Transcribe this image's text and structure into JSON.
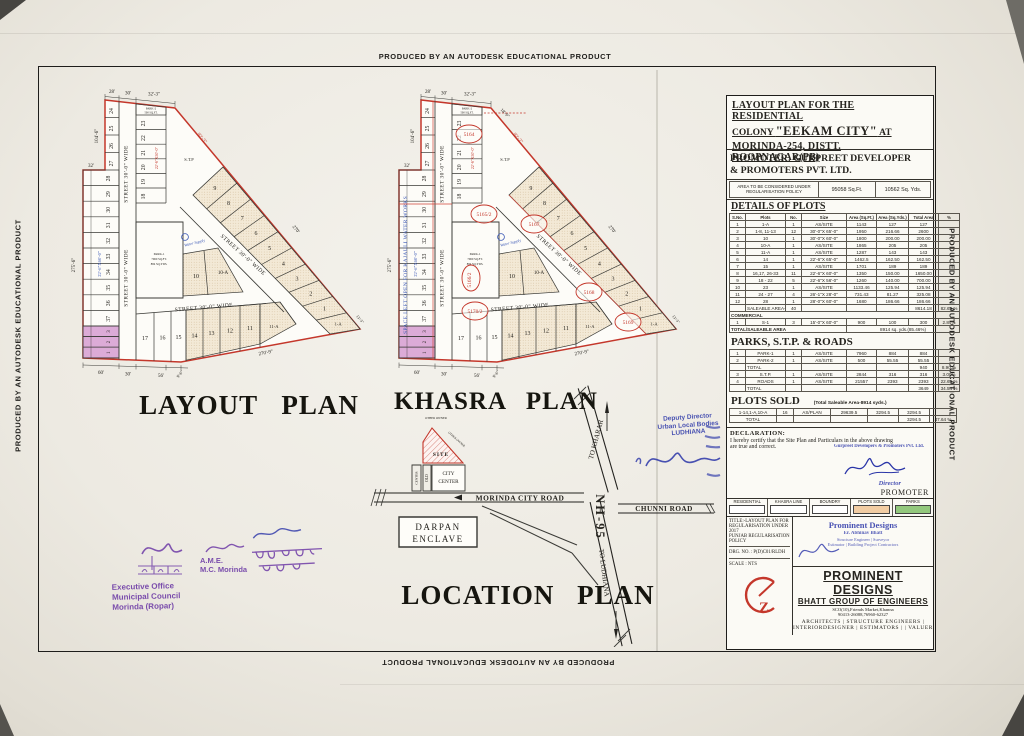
{
  "edge_text": "PRODUCED BY AN AUTODESK EDUCATIONAL PRODUCT",
  "titles": {
    "layout": "LAYOUT PLAN",
    "khasra": "KHASRA PLAN",
    "location": "LOCATION PLAN"
  },
  "colors": {
    "boundary_red": "#c4372b",
    "pink": "#dcabd7",
    "beige": "#f3e9d6",
    "stamp_purple": "#6d3ba6",
    "stamp_blue": "#2a35a8",
    "parks_green": "#93c87d",
    "sold_peach": "#f2cda3"
  },
  "plan": {
    "street_label": "STREET 30'-0\" WIDE",
    "left_plots": [
      "28",
      "29",
      "30",
      "31",
      "32",
      "33",
      "34",
      "35",
      "36",
      "37"
    ],
    "bottom_left_plots": [
      "3",
      "2",
      "1"
    ],
    "top_plots": [
      "24",
      "25",
      "26",
      "27"
    ],
    "mid_plots": [
      "23",
      "22",
      "21",
      "20",
      "19",
      "18"
    ],
    "diag_plots": [
      "9",
      "8",
      "7",
      "6",
      "5",
      "4",
      "3",
      "2",
      "1"
    ],
    "corner_plot": "1-A",
    "bottom_plots": [
      "17",
      "16",
      "15",
      "14",
      "13",
      "12",
      "11"
    ],
    "plot_11a": "11-A",
    "plot_10": "10",
    "plot_10a": "10-A",
    "park1": [
      "PARK-1",
      "7960 SQ.FT.",
      "884 SQ.YDS."
    ],
    "park2": [
      "PARK-2",
      "500 SQ.FT."
    ],
    "stp": "S.T.P",
    "water_supply": "Water Supply",
    "blue_dim": "22'-6\"X60'-0\"",
    "red_dim": "22'-6\"X50'-0\"",
    "dim_top": [
      "28'",
      "30'",
      "32'-3\""
    ],
    "dim_left": [
      "104'-6\"",
      "32'",
      "275'-6\""
    ],
    "dim_bottom": [
      "60'",
      "30'",
      "56'",
      "9'-6\""
    ],
    "dim_right": [
      "92'-3\"",
      "270'",
      "270'-9\"",
      "13'-3\""
    ]
  },
  "khasra": {
    "space_text": "SPACE LEFT OPEN FOR KAJAULI WATER WORKS",
    "dim_extra": "18'-9\"",
    "dim_diag": "92'-2\"",
    "numbers": [
      "5164",
      "5165/2",
      "5167",
      "5166/2",
      "5168",
      "5169",
      "5170/2"
    ]
  },
  "location": {
    "site": "SITE",
    "other_owner": "OTHER OWNER",
    "city_center": [
      "CITY",
      "CENTER"
    ],
    "strip_left": "CENTER",
    "strip_right": "OLD",
    "morinda_road": "MORINDA CITY ROAD",
    "darpan": [
      "DARPAN",
      "ENCLAVE"
    ],
    "nh95": "NH-95",
    "to_kharar": "TO KHARAR",
    "to_ludhiana": "TO LUDHIANA",
    "chunni": "CHUNNI ROAD"
  },
  "panel": {
    "title_l1": "LAYOUT PLAN FOR THE RESIDENTIAL",
    "title_l2a": "COLONY ",
    "title_l2b": "\"EEKAM CITY\"",
    "title_l2c": " AT",
    "title_l3": "MORINDA-254, DISTT. ROOPNAGAR(PB)",
    "promoter_l1": "PROMOTER: GURPREET DEVELOPER",
    "promoter_l2": "& PROMOTERS PVT. LTD.",
    "area_label": "AREA TO BE CONSIDERED UNDER REGULARISATION POLICY",
    "area_sqft": "95058 Sq.Ft.",
    "area_sqyd": "10562 Sq. Yds.",
    "details_heading": "DETAILS OF PLOTS",
    "headers": [
      "S.No.",
      "Plots",
      "No.",
      "Size",
      "Area (Sq.Ft.)",
      "Area (Sq.Yds.)",
      "Total Area",
      "%"
    ],
    "details_rows": [
      [
        "1",
        "1-A",
        "1",
        "AS/SITE",
        "1143",
        "127",
        "127",
        ""
      ],
      [
        "2",
        "1-8, 11-13",
        "12",
        "30'-0\"X 65'-0\"",
        "1950",
        "216.66",
        "2600",
        ""
      ],
      [
        "3",
        "10",
        "1",
        "30'-0\"X 60'-0\"",
        "1800",
        "200.00",
        "200.00",
        ""
      ],
      [
        "4",
        "10-A",
        "1",
        "AS/SITE",
        "1865",
        "205",
        "205",
        ""
      ],
      [
        "5",
        "11-A",
        "1",
        "AS/SITE",
        "1287",
        "143",
        "143",
        ""
      ],
      [
        "6",
        "14",
        "1",
        "22'-6\"X 65'-0\"",
        "1462.5",
        "162.50",
        "162.50",
        ""
      ],
      [
        "7",
        "15",
        "1",
        "AS/SITE",
        "1701",
        "189",
        "189",
        ""
      ],
      [
        "8",
        "16,17, 26-33",
        "11",
        "22'-6\"X 60'-0\"",
        "1350",
        "150.00",
        "1650.00",
        ""
      ],
      [
        "9",
        "18 - 22",
        "5",
        "22'-6\"X 56'-0\"",
        "1260",
        "140.00",
        "700.00",
        ""
      ],
      [
        "10",
        "23",
        "1",
        "AS/SITE",
        "1133.46",
        "125.94",
        "125.94",
        ""
      ],
      [
        "11",
        "24 - 27",
        "4",
        "26'-1\"X 28'-0\"",
        "731.43",
        "81.27",
        "325.08",
        ""
      ],
      [
        "12",
        "28",
        "1",
        "28'-0\"X 60'-0\"",
        "1680",
        "186.66",
        "186.66",
        ""
      ]
    ],
    "saleable_row": [
      "",
      "SALEABLE AREA-Residential",
      "40",
      "",
      "",
      "",
      "8614.18",
      "82.62 %"
    ],
    "commercial_label": "COMMERCIAL",
    "commercial_row": [
      "1",
      "S-1",
      "3",
      "15'-0\"X 60'-0\"",
      "900",
      "100",
      "300",
      "2.84%"
    ],
    "total_label": "TOTAL/SALEABLE AREA",
    "total_value": "8914 sq. yds.(85.46%)",
    "parks_heading": "PARKS, S.T.P. & ROADS",
    "parks_rows": [
      [
        "1",
        "PARK-1",
        "1",
        "AS/SITE",
        "7960",
        "884",
        "884",
        ""
      ],
      [
        "2",
        "PARK-2",
        "1",
        "AS/SITE",
        "500",
        "55.55",
        "55.55",
        ""
      ],
      [
        "",
        "TOTAL",
        "",
        "",
        "",
        "",
        "940",
        "8.90 %"
      ],
      [
        "3",
        "S.T.P.",
        "1",
        "AS/SITE",
        "2844",
        "316",
        "316",
        "3.00%"
      ],
      [
        "4",
        "ROADS",
        "1",
        "AS/SITE",
        "21557",
        "2393",
        "2393",
        "22.63 %"
      ],
      [
        "",
        "TOTAL",
        "",
        "",
        "",
        "",
        "3649",
        "34.54 %"
      ]
    ],
    "sold_heading": "PLOTS SOLD",
    "sold_note": "(Total Saleable Area-8914 syds.)",
    "sold_rows": [
      [
        "1-14,1-A,10-A",
        "16",
        "AS/PLAN",
        "29639.5",
        "3294.5",
        "3294.5",
        ""
      ],
      [
        "TOTAL",
        "",
        "",
        "",
        "",
        "3294.5",
        "47.64 %"
      ]
    ],
    "declaration_heading": "DECLARATION:",
    "declaration_line1": "I hereby certify that the Site Plan and Particulars  in the above drawing",
    "declaration_line2": "are true and correct.",
    "gurpreet_stamp": "Gurpreet Developers & Promoters Pvt. Ltd.",
    "director_label": "Director",
    "promoter_label": "PROMOTER",
    "legend": [
      {
        "label": "RESIDENTIAL",
        "fill": "#ffffff"
      },
      {
        "label": "KHASRA LINE",
        "fill": "#ffffff"
      },
      {
        "label": "BOUNDRY",
        "fill": "#ffffff"
      },
      {
        "label": "PLOTS SOLD",
        "fill": "#f2cda3"
      },
      {
        "label": "PARKS",
        "fill": "#93c87d"
      }
    ],
    "title_info": [
      "TITLE:-LAYOUT PLAN FOR",
      "REGULARISATION UNDER 2017",
      "PUNJAB REGULARISATION",
      "POLICY"
    ],
    "drg_no": "DRG. NO. : P(D)C01/RLDH",
    "scale": "SCALE : NTS",
    "pd_stamp": [
      "Prominent Designs",
      "Er. Abhinav Bhatt",
      "Structure Engineer | Surveyor",
      "Estimator | Building Project Contractors"
    ],
    "company_name": "PROMINENT DESIGNS",
    "company_sub": "BHATT GROUP OF ENGINEERS",
    "company_addr": "SCO(10),Friends Market,Khanna",
    "company_phone": "90413-26088,76960-62327",
    "company_serv1": "ARCHITECTS | STRUCTURE ENGINEERS |",
    "company_serv2": "INTERIORDESIGNER | ESTIMATORS |  | VALUER"
  },
  "stamps": {
    "deputy": [
      "Deputy Director",
      "Urban Local Bodies",
      "LUDHIANA"
    ],
    "exec": [
      "Executive Office",
      "Municipal Council",
      "Morinda (Ropar)"
    ],
    "ame": [
      "A.M.E.",
      "M.C. Morinda"
    ]
  }
}
